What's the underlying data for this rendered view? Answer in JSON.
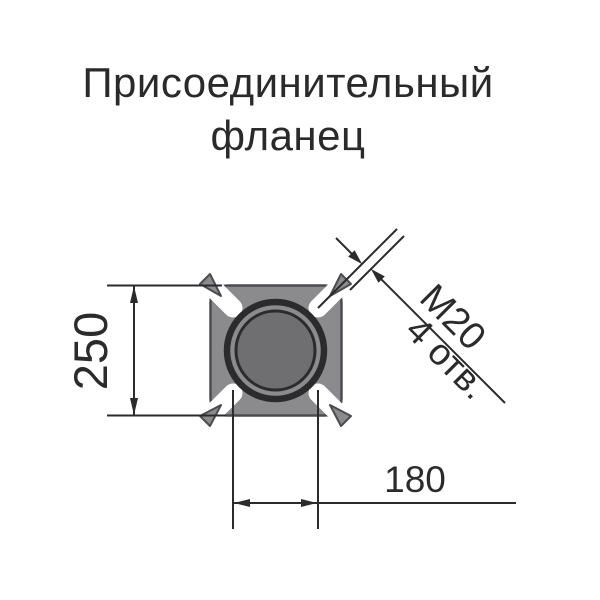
{
  "title": {
    "line1": "Присоединительный",
    "line2": "фланец"
  },
  "drawing": {
    "type": "flange-front-view",
    "dimensions": {
      "height": "250",
      "width": "180",
      "hole_thread": "M20",
      "hole_count": "4 отв."
    },
    "colors": {
      "body_fill": "#8b8b8d",
      "bore_fill": "#6f6f71",
      "body_outline": "#4c4c50",
      "line": "#2b2b2e",
      "background": "#ffffff"
    }
  }
}
